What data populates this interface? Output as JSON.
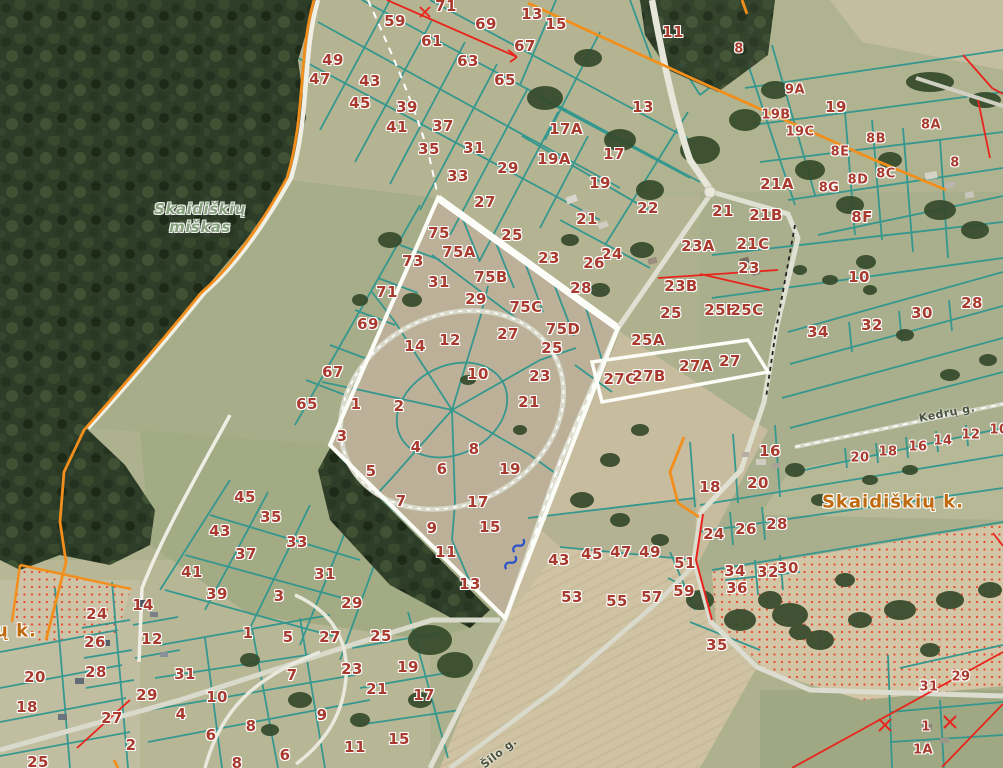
{
  "map": {
    "forest_label": {
      "line1": "Skaidiškių",
      "line2": "miškas",
      "x": 200,
      "y": 209
    },
    "village_labels": [
      {
        "text": "Skaidiškių k.",
        "x": 893,
        "y": 502
      },
      {
        "text": "ų k.",
        "x": 16,
        "y": 631
      }
    ],
    "street_labels": [
      {
        "text": "Kedrų g.",
        "x": 947,
        "y": 413,
        "rot": -11
      },
      {
        "text": "Šilo g.",
        "x": 499,
        "y": 753,
        "rot": -38
      }
    ],
    "colors": {
      "boundary_teal": "#2f968e",
      "boundary_orange": "#f28f1c",
      "boundary_red": "#e8251c",
      "parcel_number": "#a93a2e",
      "village_label": "#c06a10",
      "forest_label": "#86a07e",
      "forest_fill": "#2e3d27",
      "road_white": "#efefe6",
      "stream_symbol": "#2a52c8"
    },
    "symbols": [
      {
        "name": "stream-symbol",
        "x": 519,
        "y": 549
      },
      {
        "name": "stream-symbol",
        "x": 512,
        "y": 566
      },
      {
        "name": "survey-cross",
        "x": 885,
        "y": 725
      },
      {
        "name": "survey-cross",
        "x": 950,
        "y": 722
      }
    ],
    "parcel_labels": [
      {
        "t": "71",
        "x": 446,
        "y": 6
      },
      {
        "t": "59",
        "x": 395,
        "y": 21
      },
      {
        "t": "69",
        "x": 486,
        "y": 24
      },
      {
        "t": "61",
        "x": 432,
        "y": 41
      },
      {
        "t": "67",
        "x": 525,
        "y": 46
      },
      {
        "t": "63",
        "x": 468,
        "y": 61
      },
      {
        "t": "49",
        "x": 333,
        "y": 60
      },
      {
        "t": "47",
        "x": 320,
        "y": 79
      },
      {
        "t": "65",
        "x": 505,
        "y": 80
      },
      {
        "t": "43",
        "x": 370,
        "y": 81
      },
      {
        "t": "45",
        "x": 360,
        "y": 103
      },
      {
        "t": "39",
        "x": 407,
        "y": 107
      },
      {
        "t": "41",
        "x": 397,
        "y": 127
      },
      {
        "t": "37",
        "x": 443,
        "y": 126
      },
      {
        "t": "35",
        "x": 429,
        "y": 149
      },
      {
        "t": "31",
        "x": 474,
        "y": 148
      },
      {
        "t": "33",
        "x": 458,
        "y": 176
      },
      {
        "t": "29",
        "x": 508,
        "y": 168
      },
      {
        "t": "27",
        "x": 485,
        "y": 202
      },
      {
        "t": "13",
        "x": 532,
        "y": 14
      },
      {
        "t": "15",
        "x": 556,
        "y": 24
      },
      {
        "t": "13",
        "x": 643,
        "y": 107
      },
      {
        "t": "11",
        "x": 673,
        "y": 32
      },
      {
        "t": "17A",
        "x": 566,
        "y": 129
      },
      {
        "t": "19A",
        "x": 554,
        "y": 159
      },
      {
        "t": "17",
        "x": 614,
        "y": 154
      },
      {
        "t": "19",
        "x": 600,
        "y": 183
      },
      {
        "t": "21",
        "x": 587,
        "y": 219
      },
      {
        "t": "22",
        "x": 648,
        "y": 208
      },
      {
        "t": "25",
        "x": 512,
        "y": 235
      },
      {
        "t": "23",
        "x": 549,
        "y": 258
      },
      {
        "t": "24",
        "x": 612,
        "y": 254
      },
      {
        "t": "26",
        "x": 594,
        "y": 263
      },
      {
        "t": "28",
        "x": 581,
        "y": 288
      },
      {
        "t": "8",
        "x": 739,
        "y": 49,
        "s": 13
      },
      {
        "t": "9A",
        "x": 795,
        "y": 90,
        "s": 13
      },
      {
        "t": "19B",
        "x": 776,
        "y": 115,
        "s": 13
      },
      {
        "t": "19",
        "x": 836,
        "y": 107
      },
      {
        "t": "19C",
        "x": 800,
        "y": 132,
        "s": 13
      },
      {
        "t": "8B",
        "x": 876,
        "y": 139,
        "s": 13
      },
      {
        "t": "8A",
        "x": 931,
        "y": 125,
        "s": 13
      },
      {
        "t": "8E",
        "x": 840,
        "y": 152,
        "s": 13
      },
      {
        "t": "8",
        "x": 955,
        "y": 163,
        "s": 13
      },
      {
        "t": "8C",
        "x": 886,
        "y": 174,
        "s": 13
      },
      {
        "t": "8D",
        "x": 858,
        "y": 180,
        "s": 13
      },
      {
        "t": "8G",
        "x": 829,
        "y": 188,
        "s": 13
      },
      {
        "t": "8F",
        "x": 862,
        "y": 217
      },
      {
        "t": "21A",
        "x": 777,
        "y": 184
      },
      {
        "t": "21",
        "x": 723,
        "y": 211
      },
      {
        "t": "21B",
        "x": 766,
        "y": 215
      },
      {
        "t": "23A",
        "x": 698,
        "y": 246
      },
      {
        "t": "21C",
        "x": 753,
        "y": 244
      },
      {
        "t": "23",
        "x": 749,
        "y": 268
      },
      {
        "t": "23B",
        "x": 681,
        "y": 286
      },
      {
        "t": "25",
        "x": 671,
        "y": 313
      },
      {
        "t": "25B",
        "x": 721,
        "y": 310
      },
      {
        "t": "25C",
        "x": 747,
        "y": 310
      },
      {
        "t": "10",
        "x": 859,
        "y": 277
      },
      {
        "t": "34",
        "x": 818,
        "y": 332
      },
      {
        "t": "32",
        "x": 872,
        "y": 325
      },
      {
        "t": "30",
        "x": 922,
        "y": 313
      },
      {
        "t": "28",
        "x": 972,
        "y": 303
      },
      {
        "t": "25A",
        "x": 648,
        "y": 340
      },
      {
        "t": "27C",
        "x": 620,
        "y": 379
      },
      {
        "t": "27B",
        "x": 649,
        "y": 376
      },
      {
        "t": "27A",
        "x": 696,
        "y": 366
      },
      {
        "t": "27",
        "x": 730,
        "y": 361
      },
      {
        "t": "20",
        "x": 860,
        "y": 458,
        "s": 13
      },
      {
        "t": "18",
        "x": 888,
        "y": 452,
        "s": 13
      },
      {
        "t": "16",
        "x": 918,
        "y": 447,
        "s": 13
      },
      {
        "t": "14",
        "x": 943,
        "y": 441,
        "s": 13
      },
      {
        "t": "12",
        "x": 971,
        "y": 435,
        "s": 13
      },
      {
        "t": "10",
        "x": 999,
        "y": 430,
        "s": 13
      },
      {
        "t": "16",
        "x": 770,
        "y": 451
      },
      {
        "t": "18",
        "x": 710,
        "y": 487
      },
      {
        "t": "20",
        "x": 758,
        "y": 483
      },
      {
        "t": "24",
        "x": 714,
        "y": 534
      },
      {
        "t": "26",
        "x": 746,
        "y": 529
      },
      {
        "t": "28",
        "x": 777,
        "y": 524
      },
      {
        "t": "34",
        "x": 735,
        "y": 571
      },
      {
        "t": "32",
        "x": 768,
        "y": 572
      },
      {
        "t": "30",
        "x": 788,
        "y": 568
      },
      {
        "t": "36",
        "x": 737,
        "y": 588
      },
      {
        "t": "51",
        "x": 685,
        "y": 563
      },
      {
        "t": "59",
        "x": 684,
        "y": 591
      },
      {
        "t": "35",
        "x": 717,
        "y": 645
      },
      {
        "t": "31",
        "x": 929,
        "y": 687,
        "s": 13
      },
      {
        "t": "29",
        "x": 961,
        "y": 677,
        "s": 13
      },
      {
        "t": "1",
        "x": 926,
        "y": 727,
        "s": 13
      },
      {
        "t": "1A",
        "x": 923,
        "y": 750,
        "s": 13
      },
      {
        "t": "43",
        "x": 559,
        "y": 560
      },
      {
        "t": "45",
        "x": 592,
        "y": 554
      },
      {
        "t": "47",
        "x": 621,
        "y": 552
      },
      {
        "t": "49",
        "x": 650,
        "y": 552
      },
      {
        "t": "53",
        "x": 572,
        "y": 597
      },
      {
        "t": "55",
        "x": 617,
        "y": 601
      },
      {
        "t": "57",
        "x": 652,
        "y": 597
      },
      {
        "t": "75",
        "x": 439,
        "y": 233
      },
      {
        "t": "75A",
        "x": 459,
        "y": 252
      },
      {
        "t": "73",
        "x": 413,
        "y": 261
      },
      {
        "t": "75B",
        "x": 491,
        "y": 277
      },
      {
        "t": "31",
        "x": 439,
        "y": 282
      },
      {
        "t": "29",
        "x": 476,
        "y": 299
      },
      {
        "t": "71",
        "x": 387,
        "y": 292
      },
      {
        "t": "75C",
        "x": 526,
        "y": 307
      },
      {
        "t": "27",
        "x": 508,
        "y": 334
      },
      {
        "t": "69",
        "x": 368,
        "y": 324
      },
      {
        "t": "75D",
        "x": 563,
        "y": 329
      },
      {
        "t": "25",
        "x": 552,
        "y": 348
      },
      {
        "t": "14",
        "x": 415,
        "y": 346
      },
      {
        "t": "12",
        "x": 450,
        "y": 340
      },
      {
        "t": "23",
        "x": 540,
        "y": 376
      },
      {
        "t": "10",
        "x": 478,
        "y": 374
      },
      {
        "t": "21",
        "x": 529,
        "y": 402
      },
      {
        "t": "67",
        "x": 333,
        "y": 372
      },
      {
        "t": "65",
        "x": 307,
        "y": 404
      },
      {
        "t": "1",
        "x": 356,
        "y": 404
      },
      {
        "t": "2",
        "x": 399,
        "y": 406
      },
      {
        "t": "3",
        "x": 342,
        "y": 436
      },
      {
        "t": "4",
        "x": 416,
        "y": 447
      },
      {
        "t": "8",
        "x": 474,
        "y": 449
      },
      {
        "t": "5",
        "x": 371,
        "y": 471
      },
      {
        "t": "6",
        "x": 442,
        "y": 469
      },
      {
        "t": "19",
        "x": 510,
        "y": 469
      },
      {
        "t": "7",
        "x": 401,
        "y": 501
      },
      {
        "t": "17",
        "x": 478,
        "y": 502
      },
      {
        "t": "9",
        "x": 432,
        "y": 528
      },
      {
        "t": "15",
        "x": 490,
        "y": 527
      },
      {
        "t": "11",
        "x": 446,
        "y": 552
      },
      {
        "t": "13",
        "x": 470,
        "y": 584
      },
      {
        "t": "45",
        "x": 245,
        "y": 497
      },
      {
        "t": "35",
        "x": 271,
        "y": 517
      },
      {
        "t": "43",
        "x": 220,
        "y": 531
      },
      {
        "t": "33",
        "x": 297,
        "y": 542
      },
      {
        "t": "37",
        "x": 246,
        "y": 554
      },
      {
        "t": "41",
        "x": 192,
        "y": 572
      },
      {
        "t": "31",
        "x": 325,
        "y": 574
      },
      {
        "t": "39",
        "x": 217,
        "y": 594
      },
      {
        "t": "3",
        "x": 279,
        "y": 596
      },
      {
        "t": "24",
        "x": 97,
        "y": 614
      },
      {
        "t": "14",
        "x": 143,
        "y": 605
      },
      {
        "t": "12",
        "x": 152,
        "y": 639
      },
      {
        "t": "26",
        "x": 95,
        "y": 642
      },
      {
        "t": "1",
        "x": 248,
        "y": 633
      },
      {
        "t": "5",
        "x": 288,
        "y": 637
      },
      {
        "t": "27",
        "x": 330,
        "y": 637
      },
      {
        "t": "28",
        "x": 96,
        "y": 672
      },
      {
        "t": "20",
        "x": 35,
        "y": 677
      },
      {
        "t": "31",
        "x": 185,
        "y": 674
      },
      {
        "t": "18",
        "x": 27,
        "y": 707
      },
      {
        "t": "29",
        "x": 147,
        "y": 695
      },
      {
        "t": "27",
        "x": 112,
        "y": 718
      },
      {
        "t": "10",
        "x": 217,
        "y": 697
      },
      {
        "t": "4",
        "x": 181,
        "y": 714
      },
      {
        "t": "7",
        "x": 292,
        "y": 675
      },
      {
        "t": "2",
        "x": 131,
        "y": 745
      },
      {
        "t": "6",
        "x": 211,
        "y": 735
      },
      {
        "t": "8",
        "x": 251,
        "y": 726
      },
      {
        "t": "9",
        "x": 322,
        "y": 715
      },
      {
        "t": "6",
        "x": 285,
        "y": 755
      },
      {
        "t": "8",
        "x": 237,
        "y": 763
      },
      {
        "t": "25",
        "x": 38,
        "y": 762
      },
      {
        "t": "29",
        "x": 352,
        "y": 603
      },
      {
        "t": "25",
        "x": 381,
        "y": 636
      },
      {
        "t": "23",
        "x": 352,
        "y": 669
      },
      {
        "t": "21",
        "x": 377,
        "y": 689
      },
      {
        "t": "19",
        "x": 408,
        "y": 667
      },
      {
        "t": "17",
        "x": 424,
        "y": 695
      },
      {
        "t": "15",
        "x": 399,
        "y": 739
      },
      {
        "t": "11",
        "x": 355,
        "y": 747
      }
    ]
  }
}
